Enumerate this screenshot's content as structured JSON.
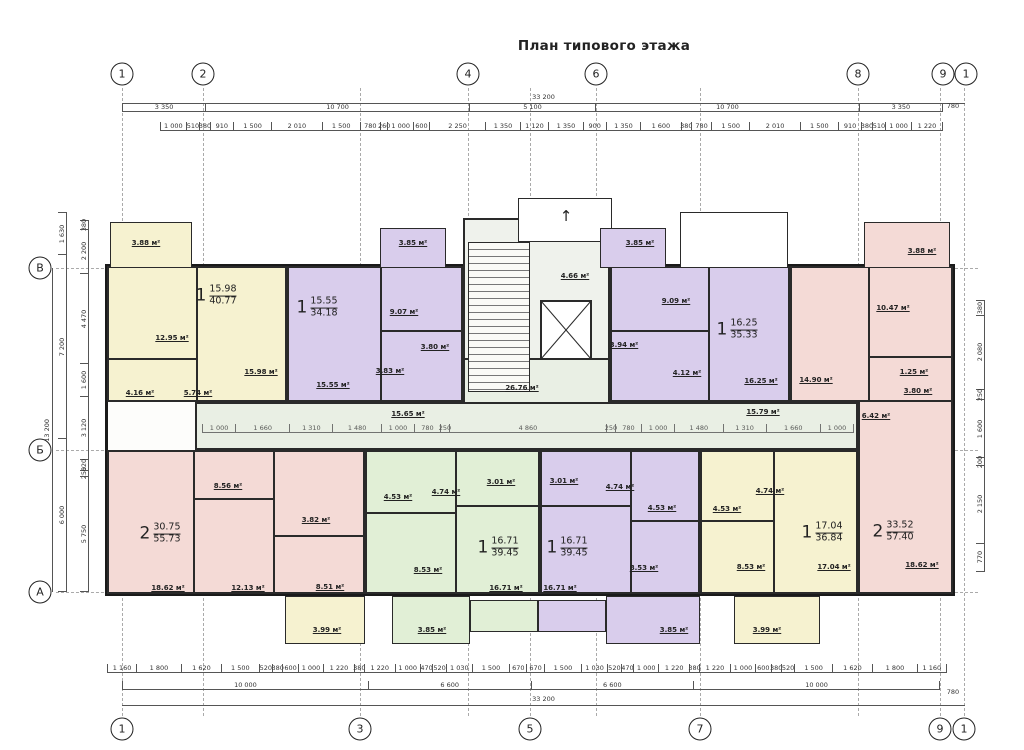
{
  "title": "План типового этажа",
  "colors": {
    "yellow": "#f6f2d0",
    "purple": "#d9cdec",
    "pink": "#f4dad6",
    "green": "#e1efd6",
    "corridor": "#e9efe4",
    "wall": "#1a1a1a"
  },
  "grid": {
    "top": [
      "1",
      "2",
      "4",
      "6",
      "8",
      "9",
      "1"
    ],
    "bottom": [
      "1",
      "3",
      "5",
      "7",
      "9",
      "1"
    ],
    "left": [
      "В",
      "Б",
      "А"
    ]
  },
  "dims": {
    "top_overall": "33 200",
    "top_spans": [
      "3 350",
      "10 700",
      "5 100",
      "10 700",
      "3 350"
    ],
    "top_offset": "780",
    "top_chain": [
      "1 000",
      "510",
      "380",
      "910",
      "1 500",
      "2 010",
      "1 500",
      "780",
      "260",
      "1 000",
      "600",
      "2 250",
      "1 350",
      "1 120",
      "1 350",
      "900",
      "1 350",
      "1 600",
      "380",
      "780",
      "1 500",
      "2 010",
      "1 500",
      "910",
      "380",
      "510",
      "1 000",
      "1 220"
    ],
    "corridor_chain": [
      "1 000",
      "1 660",
      "1 310",
      "1 480",
      "1 000",
      "780",
      "250",
      "4 860",
      "250",
      "780",
      "1 000",
      "1 480",
      "1 310",
      "1 660",
      "1 000"
    ],
    "bottom_chain": [
      "1 160",
      "1 800",
      "1 620",
      "1 500",
      "520",
      "380",
      "600",
      "1 000",
      "1 220",
      "380",
      "1 220",
      "1 000",
      "470",
      "520",
      "1 030",
      "1 500",
      "670",
      "670",
      "1 500",
      "1 030",
      "520",
      "470",
      "1 000",
      "1 220",
      "380",
      "1 220",
      "1 000",
      "600",
      "380",
      "520",
      "1 500",
      "1 620",
      "1 800",
      "1 160"
    ],
    "bottom_spans": [
      "10 000",
      "6 600",
      "6 600",
      "10 000"
    ],
    "bottom_overall": "33 200",
    "bottom_offset": "780",
    "left_overall": "13 200",
    "left_spans": [
      "1 630",
      "7 200",
      "6 000"
    ],
    "left_detail": [
      "380",
      "2 200",
      "4 470",
      "1 600",
      "3 120",
      "520",
      "250",
      "5 750"
    ],
    "right_detail": [
      "380",
      "2 080",
      "250",
      "1 600",
      "200",
      "2 150",
      "770"
    ]
  },
  "apartments": [
    {
      "id": "a1",
      "type": "1",
      "living": "15.98",
      "total": "40.77",
      "rooms": {
        "room": "15.98 м²",
        "kitchen": "12.95 м²",
        "hall": "5.74 м²",
        "bath": "4.16 м²",
        "balcony": "3.88 м²"
      }
    },
    {
      "id": "a2",
      "type": "1",
      "living": "15.55",
      "total": "34.18",
      "rooms": {
        "room": "15.55 м²",
        "kitchen": "9.07 м²",
        "bath": "3.80 м²",
        "hall": "3.83 м²",
        "balcony": "3.85 м²"
      }
    },
    {
      "id": "a3",
      "type": "1",
      "living": "16.25",
      "total": "35.33",
      "rooms": {
        "room": "16.25 м²",
        "kitchen": "9.09 м²",
        "bath": "3.94 м²",
        "hall": "4.12 м²",
        "balcony": "3.85 м²"
      }
    },
    {
      "id": "a4",
      "type": "2",
      "living": "33.52",
      "total": "57.40",
      "rooms": {
        "room1": "14.90 м²",
        "room2": "18.62 м²",
        "kitchen": "10.47 м²",
        "hall": "6.42 м²",
        "wc": "1.25 м²",
        "bath": "3.80 м²",
        "balcony": "3.88 м²"
      }
    },
    {
      "id": "b1",
      "type": "2",
      "living": "30.75",
      "total": "55.73",
      "rooms": {
        "room1": "18.62 м²",
        "room2": "12.13 м²",
        "kitchen": "8.51 м²",
        "hall": "8.56 м²",
        "bath": "3.82 м²",
        "balcony": "3.99 м²"
      }
    },
    {
      "id": "b2",
      "type": "1",
      "living": "16.71",
      "total": "39.45",
      "rooms": {
        "room": "16.71 м²",
        "kitchen": "8.53 м²",
        "hall": "4.74 м²",
        "bath": "4.53 м²",
        "loggia": "3.01 м²",
        "balcony": "3.85 м²"
      }
    },
    {
      "id": "b3",
      "type": "1",
      "living": "16.71",
      "total": "39.45",
      "rooms": {
        "room": "16.71 м²",
        "kitchen": "8.53 м²",
        "hall": "4.74 м²",
        "bath": "4.53 м²",
        "loggia": "3.01 м²",
        "balcony": "3.85 м²"
      }
    },
    {
      "id": "b4",
      "type": "1",
      "living": "17.04",
      "total": "36.84",
      "rooms": {
        "room": "17.04 м²",
        "kitchen": "8.53 м²",
        "hall": "4.74 м²",
        "bath": "4.53 м²",
        "balcony": "3.99 м²"
      }
    }
  ],
  "common": {
    "lobby": "4.66 м²",
    "corridor_left": "15.65 м²",
    "corridor_center": "26.76 м²",
    "corridor_right": "15.79 м²"
  }
}
